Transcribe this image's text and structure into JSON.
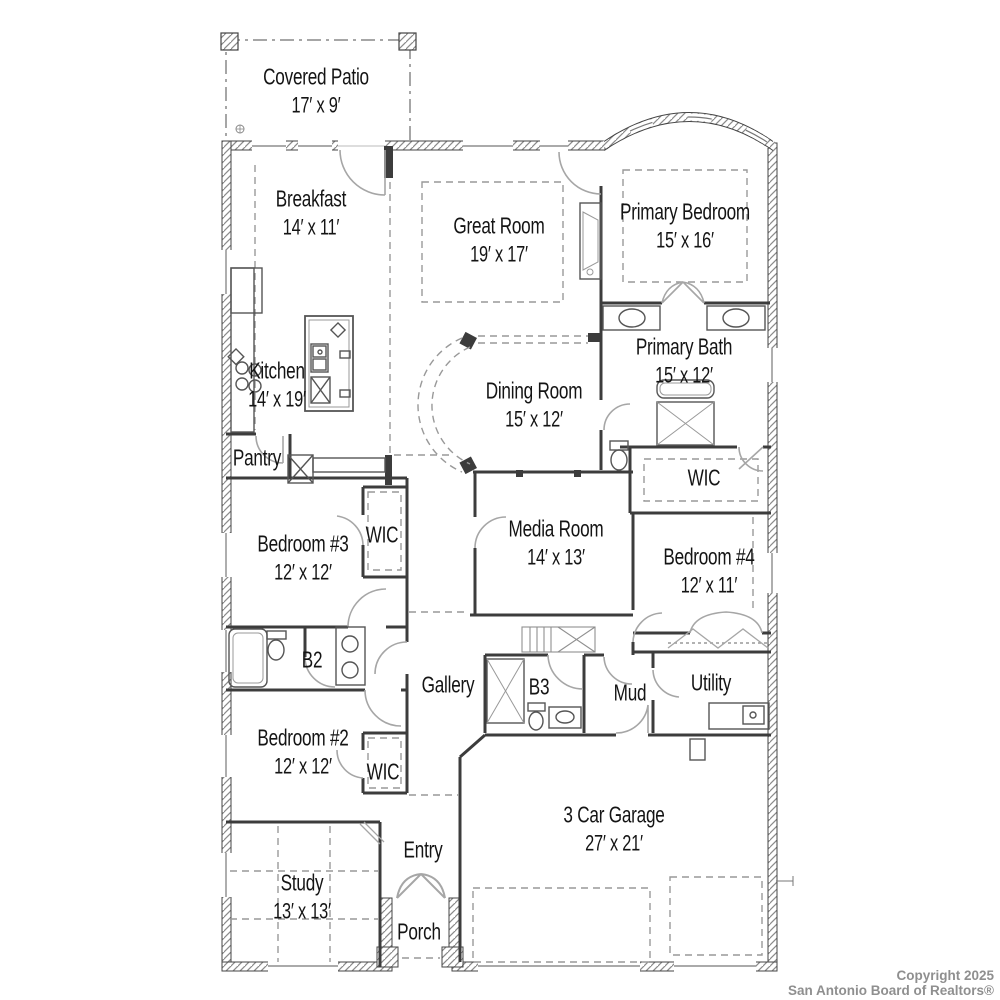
{
  "watermark": {
    "line1": "Copyright 2025",
    "line2": "San Antonio Board of Realtors®"
  },
  "rooms": [
    {
      "id": "covered-patio",
      "name": "Covered Patio",
      "dims": "17′ x 9′"
    },
    {
      "id": "breakfast",
      "name": "Breakfast",
      "dims": "14′ x 11′"
    },
    {
      "id": "great-room",
      "name": "Great Room",
      "dims": "19′ x 17′"
    },
    {
      "id": "primary-bedroom",
      "name": "Primary Bedroom",
      "dims": "15′ x 16′"
    },
    {
      "id": "kitchen",
      "name": "Kitchen",
      "dims": "14′ x 19′"
    },
    {
      "id": "dining-room",
      "name": "Dining Room",
      "dims": "15′ x 12′"
    },
    {
      "id": "primary-bath",
      "name": "Primary Bath",
      "dims": "15′ x 12′"
    },
    {
      "id": "pantry",
      "name": "Pantry",
      "dims": ""
    },
    {
      "id": "wic-primary",
      "name": "WIC",
      "dims": ""
    },
    {
      "id": "bedroom-3",
      "name": "Bedroom #3",
      "dims": "12′ x 12′"
    },
    {
      "id": "wic-bedroom-3",
      "name": "WIC",
      "dims": ""
    },
    {
      "id": "media-room",
      "name": "Media Room",
      "dims": "14′ x 13′"
    },
    {
      "id": "bedroom-4",
      "name": "Bedroom #4",
      "dims": "12′ x 11′"
    },
    {
      "id": "bath-2",
      "name": "B2",
      "dims": ""
    },
    {
      "id": "gallery",
      "name": "Gallery",
      "dims": ""
    },
    {
      "id": "bath-3",
      "name": "B3",
      "dims": ""
    },
    {
      "id": "mud",
      "name": "Mud",
      "dims": ""
    },
    {
      "id": "utility",
      "name": "Utility",
      "dims": ""
    },
    {
      "id": "bedroom-2",
      "name": "Bedroom #2",
      "dims": "12′ x 12′"
    },
    {
      "id": "wic-bedroom-2",
      "name": "WIC",
      "dims": ""
    },
    {
      "id": "study",
      "name": "Study",
      "dims": "13′ x 13′"
    },
    {
      "id": "entry",
      "name": "Entry",
      "dims": ""
    },
    {
      "id": "porch",
      "name": "Porch",
      "dims": ""
    },
    {
      "id": "garage",
      "name": "3 Car Garage",
      "dims": "27′ x 21′"
    }
  ],
  "colors": {
    "background": "#ffffff",
    "wall": "#3c3c3c",
    "door": "#a6a6a6",
    "dashed": "#999999",
    "hatch": "#8a8a8a",
    "watermark_text": "#8f8f8f"
  }
}
